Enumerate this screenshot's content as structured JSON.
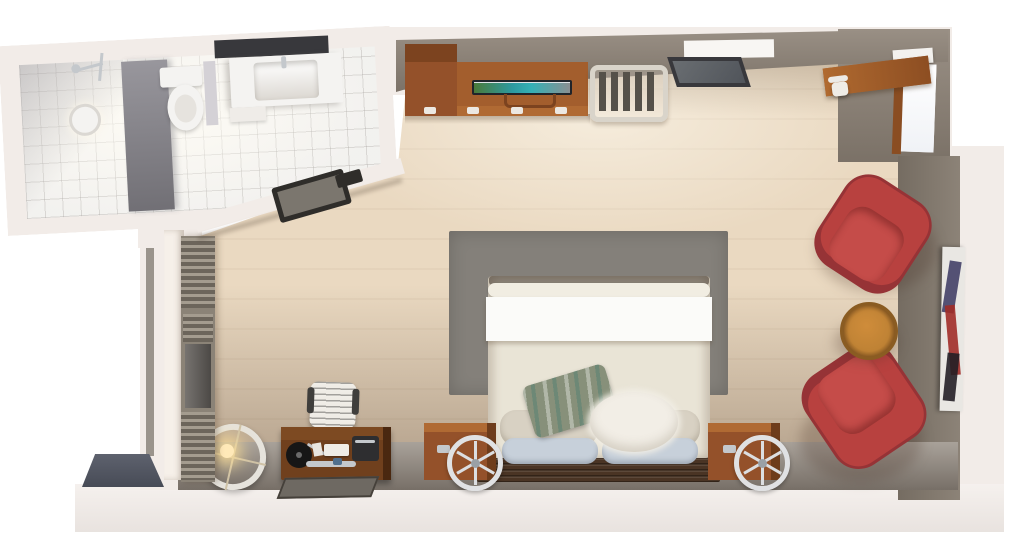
{
  "meta": {
    "description": "Top-down 3D architectural render of a studio hotel room with en-suite bathroom",
    "view": "overhead cutaway floor plan",
    "width_px": 1024,
    "height_px": 544
  },
  "rooms": {
    "bathroom": {
      "name": "bathroom",
      "items": [
        "walk-in-shower",
        "shower-fixture",
        "ceiling-light",
        "glass-partition",
        "toilet",
        "vanity-counter",
        "sink-basin",
        "vanity-mirror",
        "tiled-floor",
        "door-frame"
      ]
    },
    "bedroom": {
      "name": "bedroom-studio",
      "items": [
        "double-bed",
        "area-rug",
        "headboard",
        "pillows",
        "nightstand-left",
        "nightstand-right",
        "wheel-clock-left",
        "wheel-clock-right",
        "wardrobe",
        "dresser",
        "television",
        "luggage-rack",
        "leaning-mirror",
        "corner-desk",
        "corner-desk-chair",
        "window-right",
        "lounge-chair-top",
        "lounge-chair-bottom",
        "round-side-table",
        "wall-artwork",
        "writing-desk",
        "desk-chair",
        "record-player",
        "ring-floor-lamp",
        "radiator-blinds",
        "left-window",
        "floor-mat",
        "entry-step"
      ]
    }
  },
  "colors": {
    "page": "#ffffff",
    "plate": "#f2ece8",
    "plate_deep": "#e8e1dd",
    "wall_top": "#8f8478",
    "wall_right": "#857b6f",
    "wall_bottom": "#958d84",
    "wall_left_face": "#f6f0e9",
    "floor": "#ead9c1",
    "rug": "#84807a",
    "tile": "#fafaf8",
    "partition": "#8a888f",
    "porcelain": "#f4f3f1",
    "mirror_dark": "#38383c",
    "wood_dark": "#94512a",
    "wood_mid": "#a35e2d",
    "wood_light_edge": "#b06a33",
    "wood_desk": "#70401d",
    "wood_corner_desk": "#a8622d",
    "wood_table": "#c08335",
    "wood_headboard": "#4a3424",
    "bed_duvet": "#e9e4d6",
    "bed_sheet": "#fbfbf9",
    "pillow_beige": "#d8d1c3",
    "pillow_blue": "#c7d0da",
    "pillow_green": "#87907a",
    "pillow_fur": "#f2eee6",
    "chair_red": "#b8413f",
    "chair_red_dark": "#963336",
    "chair_red_cushion": "#c54c49",
    "metal_light": "#d9d4ca",
    "strap_dark": "#55514a",
    "tv_frame": "#20242a",
    "lamp_ring": "#e6e3dc",
    "lamp_glow": "#ffe9b8",
    "window_white": "#ffffff",
    "exterior_glass": "#9a948c",
    "art_canvas": "#e9e7e3",
    "art_red": "#a12c28",
    "art_dark": "#241f26",
    "art_blue": "#3a3660",
    "entry_step": "#565a66",
    "mat_dark": "#6e6962",
    "record_black": "#161616",
    "radiator_base": "#8b8377",
    "glass_dark": "#5f5b57",
    "door_dark": "#2f2d2a",
    "silver": "#c4c8cc",
    "chair_white": "#efece6"
  }
}
